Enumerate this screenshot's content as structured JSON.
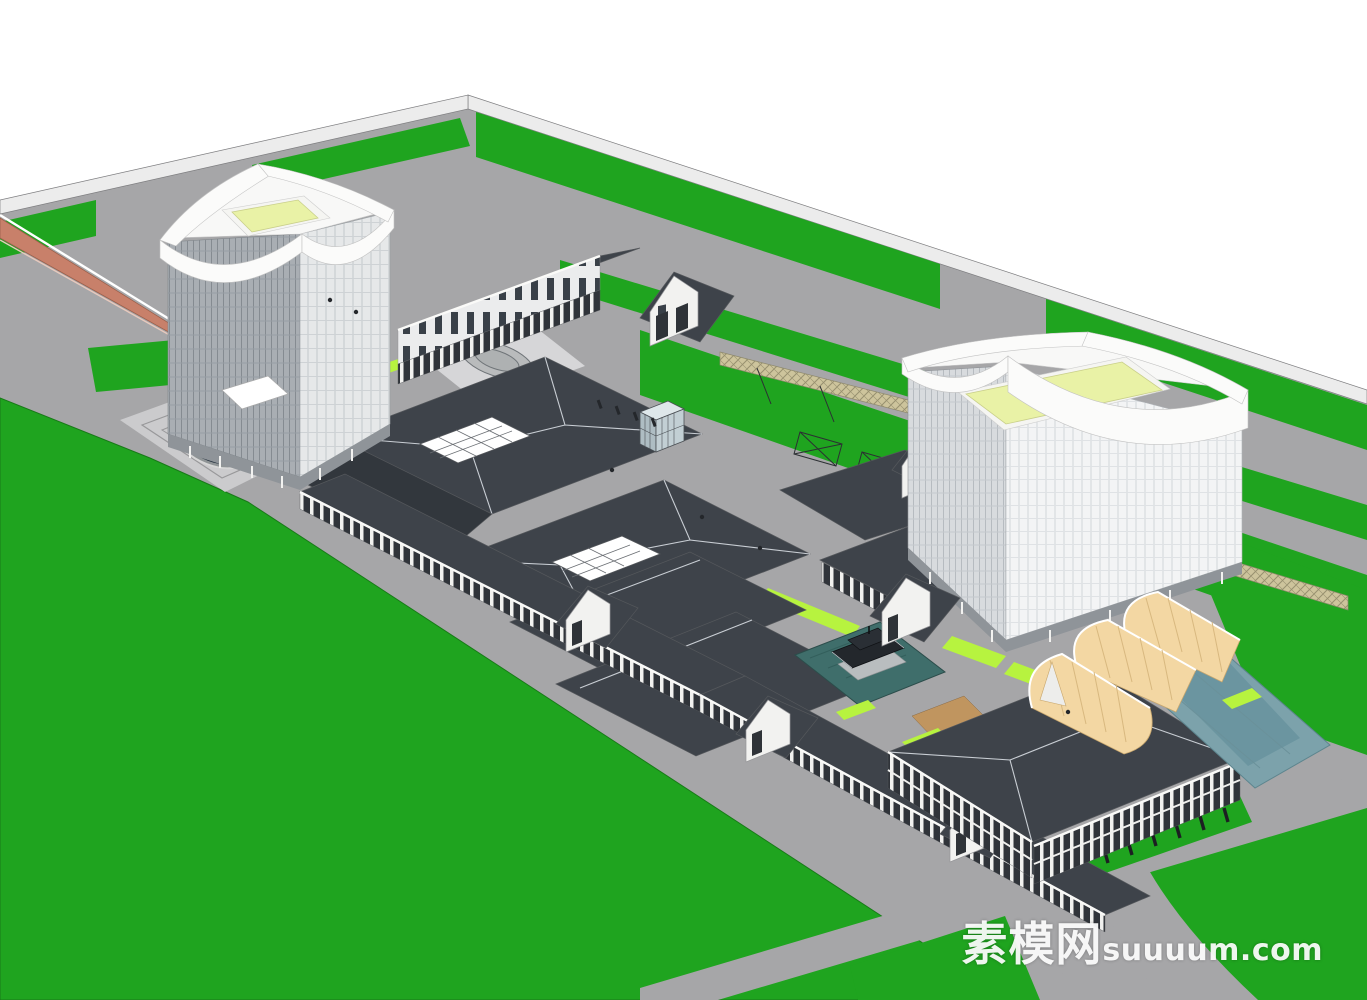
{
  "watermark": {
    "cjk": "素模网",
    "latin": "suuuum.com",
    "full_text": "素模网suuuum.com"
  },
  "palette": {
    "lawn": "#1FA41F",
    "lawn_edge": "#187A18",
    "accent": "#B7F33F",
    "road": "#A6A6A8",
    "sidewalk": "#ECECEC",
    "plaza": "#CBCBCD",
    "plaza_light": "#D6D6D8",
    "roof_dark": "#3E434A",
    "roof_deep": "#32373D",
    "ridge": "#C9CED4",
    "facade_white": "#F2F2F0",
    "storefront": "#2F3338",
    "bridge": "#C8806A",
    "tent": "#F3D7A3",
    "tent_line": "#D8B87F",
    "water_pool": "#7CA2AB",
    "water_pond": "#3F6E6B",
    "pond_dark": "#1E2B39",
    "roof_garden": "#E9F2A6",
    "deck_wood": "#C0955F",
    "trellis": "#CDC49C",
    "outline": "#55585C",
    "background": "#FFFFFF"
  },
  "scene": {
    "type": "3d-architectural-massing-render",
    "elements": [
      "left-office-tower-with-curved-parapet-and-roof-garden",
      "right-office-tower-with-curved-parapet-and-roof-garden",
      "traditional-dark-roof-retail-complex-with-skylights",
      "colonnade-retail-street",
      "pagoda-pavilion-on-pond",
      "yellow-vaulted-tent-halls",
      "oval-reflecting-pool",
      "orange-pedestrian-bridge",
      "perimeter-roads-with-green-medians",
      "pergola-trellis-strips",
      "sunken-patterned-plaza",
      "parking-stalls-with-grass-strips"
    ]
  }
}
